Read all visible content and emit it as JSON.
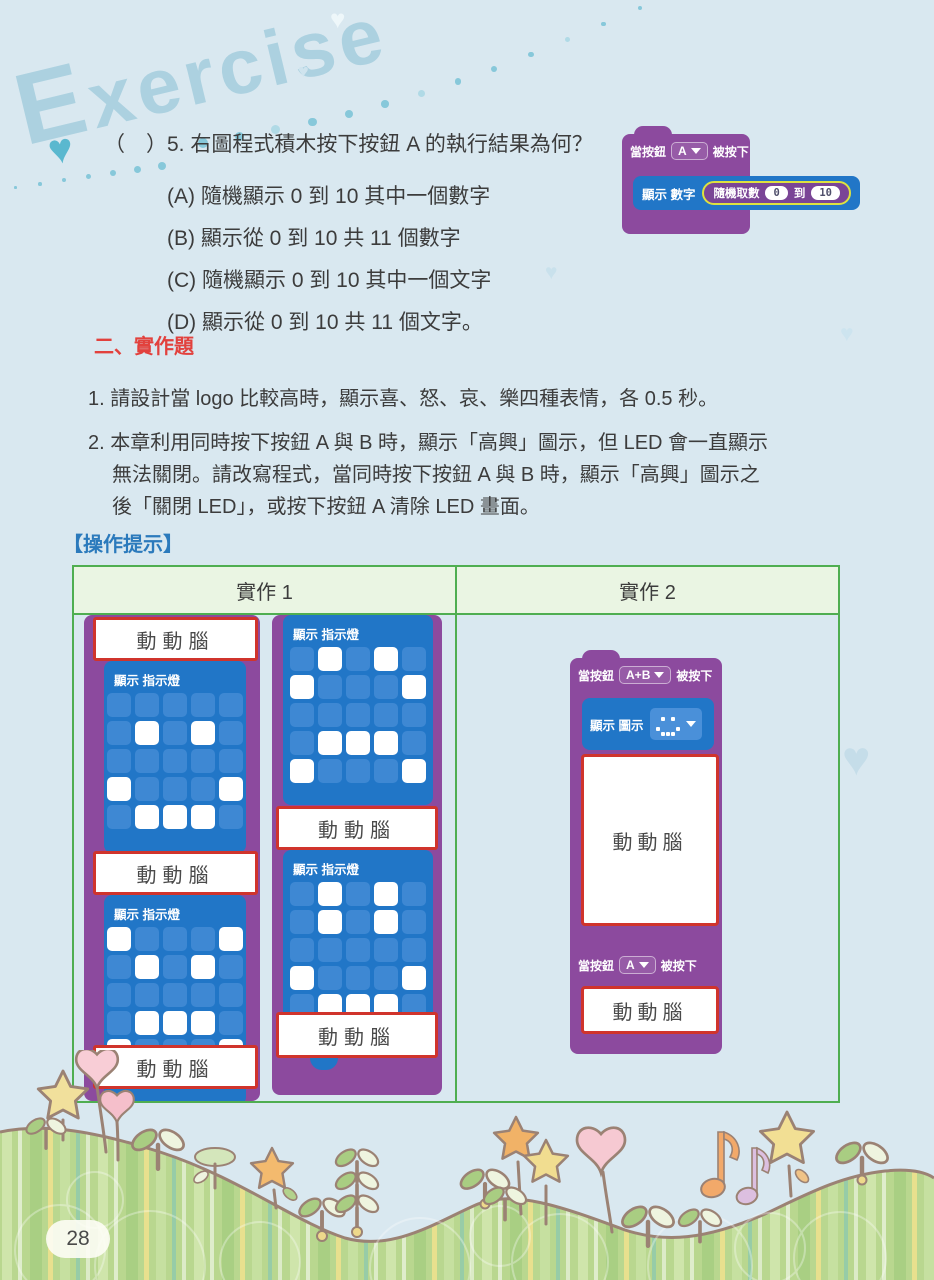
{
  "page": {
    "exercise_logo": "Exercise",
    "page_number": "28"
  },
  "colors": {
    "background": "#d9e8f0",
    "block_purple": "#8c4a9e",
    "block_blue": "#2176c7",
    "random_purple": "#7a4596",
    "random_outline": "#dde23f",
    "table_green": "#4fae51",
    "table_header_bg": "#eaf5e3",
    "red_box_border": "#d0342c",
    "heading_red": "#e2413d",
    "hint_blue": "#2b7abc",
    "hill_green": "#b9d78f"
  },
  "question5": {
    "answer_space": "（　）",
    "number": "5.",
    "stem": "右圖程式積木按下按鈕 A 的執行結果為何？",
    "options": [
      {
        "label": "(A)",
        "text": "隨機顯示 0 到 10 其中一個數字"
      },
      {
        "label": "(B)",
        "text": "顯示從 0 到 10 共 11 個數字"
      },
      {
        "label": "(C)",
        "text": "隨機顯示 0 到 10 其中一個文字"
      },
      {
        "label": "(D)",
        "text": "顯示從 0 到 10 共 11 個文字。"
      }
    ],
    "block": {
      "when_prefix": "當按鈕",
      "button": "A",
      "when_suffix": "被按下",
      "show_label": "顯示 數字",
      "random_label": "隨機取數",
      "from": "0",
      "to_word": "到",
      "to": "10"
    }
  },
  "section2": {
    "heading": "二、實作題",
    "item1": "1. 請設計當 logo 比較高時，顯示喜、怒、哀、樂四種表情，各 0.5 秒。",
    "item2_lines": [
      "2. 本章利用同時按下按鈕 A 與 B 時，顯示「高興」圖示，但 LED 會一直顯示",
      "無法關閉。請改寫程式，當同時按下按鈕 A 與 B 時，顯示「高興」圖示之",
      "後「關閉 LED」，或按下按鈕 A 清除 LED 畫面。"
    ],
    "hint_label": "【操作提示】"
  },
  "brainstorm_label": "動動腦",
  "table": {
    "headers": [
      "實作 1",
      "實作 2"
    ],
    "left": {
      "col_a_blocks": [
        {
          "label": "顯示 指示燈",
          "pattern": [
            "00000",
            "01010",
            "00000",
            "10001",
            "01110"
          ]
        },
        {
          "label": "顯示 指示燈",
          "pattern": [
            "10001",
            "01010",
            "00000",
            "01110",
            "10001"
          ]
        }
      ],
      "col_b_blocks": [
        {
          "label": "顯示 指示燈",
          "pattern": [
            "01010",
            "10001",
            "00000",
            "01110",
            "10001"
          ]
        },
        {
          "label": "顯示 指示燈",
          "pattern": [
            "01010",
            "01010",
            "00000",
            "10001",
            "01110"
          ]
        }
      ]
    },
    "right": {
      "hat1": {
        "prefix": "當按鈕",
        "button": "A+B",
        "suffix": "被按下"
      },
      "show_icon": {
        "label": "顯示 圖示",
        "icon_pattern": [
          "00000",
          "01010",
          "00000",
          "10001",
          "01110"
        ]
      },
      "hat2": {
        "prefix": "當按鈕",
        "button": "A",
        "suffix": "被按下"
      }
    }
  }
}
